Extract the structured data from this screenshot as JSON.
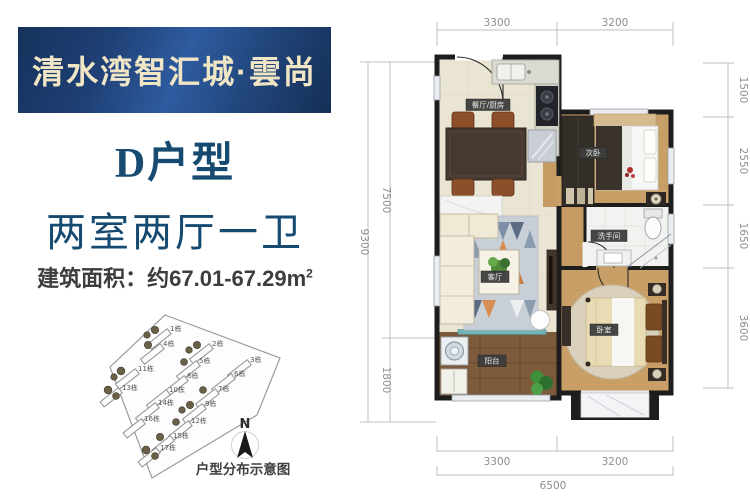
{
  "banner": {
    "project_name": "清水湾智汇城·雲尚"
  },
  "unit": {
    "type": "D户型",
    "rooms_summary": "两室两厅一卫",
    "area": "建筑面积：约67.01-67.29m",
    "area_exponent": "2"
  },
  "site_plan": {
    "caption": "户型分布示意图",
    "north": "N",
    "buildings": [
      "1栋",
      "2栋",
      "3栋",
      "4栋",
      "5栋",
      "6栋",
      "7栋",
      "8栋",
      "9栋",
      "10栋",
      "11栋",
      "12栋",
      "13栋",
      "14栋",
      "15栋",
      "16栋",
      "17栋"
    ]
  },
  "floor_plan": {
    "rooms": {
      "dining_kitchen": "餐厅/厨房",
      "second_bedroom": "次卧",
      "bathroom": "洗手间",
      "living": "客厅",
      "master_bedroom": "卧室",
      "balcony": "阳台"
    },
    "dimensions": {
      "top": [
        "3300",
        "3200"
      ],
      "right": [
        "1500",
        "2550",
        "1650",
        "3600"
      ],
      "left_total": "9300",
      "left": [
        "7500",
        "1800"
      ],
      "bottom": [
        "3300",
        "3200"
      ],
      "bottom_total": "6500"
    }
  },
  "colors": {
    "banner_blue": "#1f4076",
    "title_blue": "#164a70",
    "wall": "#1d1d1d",
    "wood": "#c89f66",
    "badge": "#3d3d3d"
  }
}
